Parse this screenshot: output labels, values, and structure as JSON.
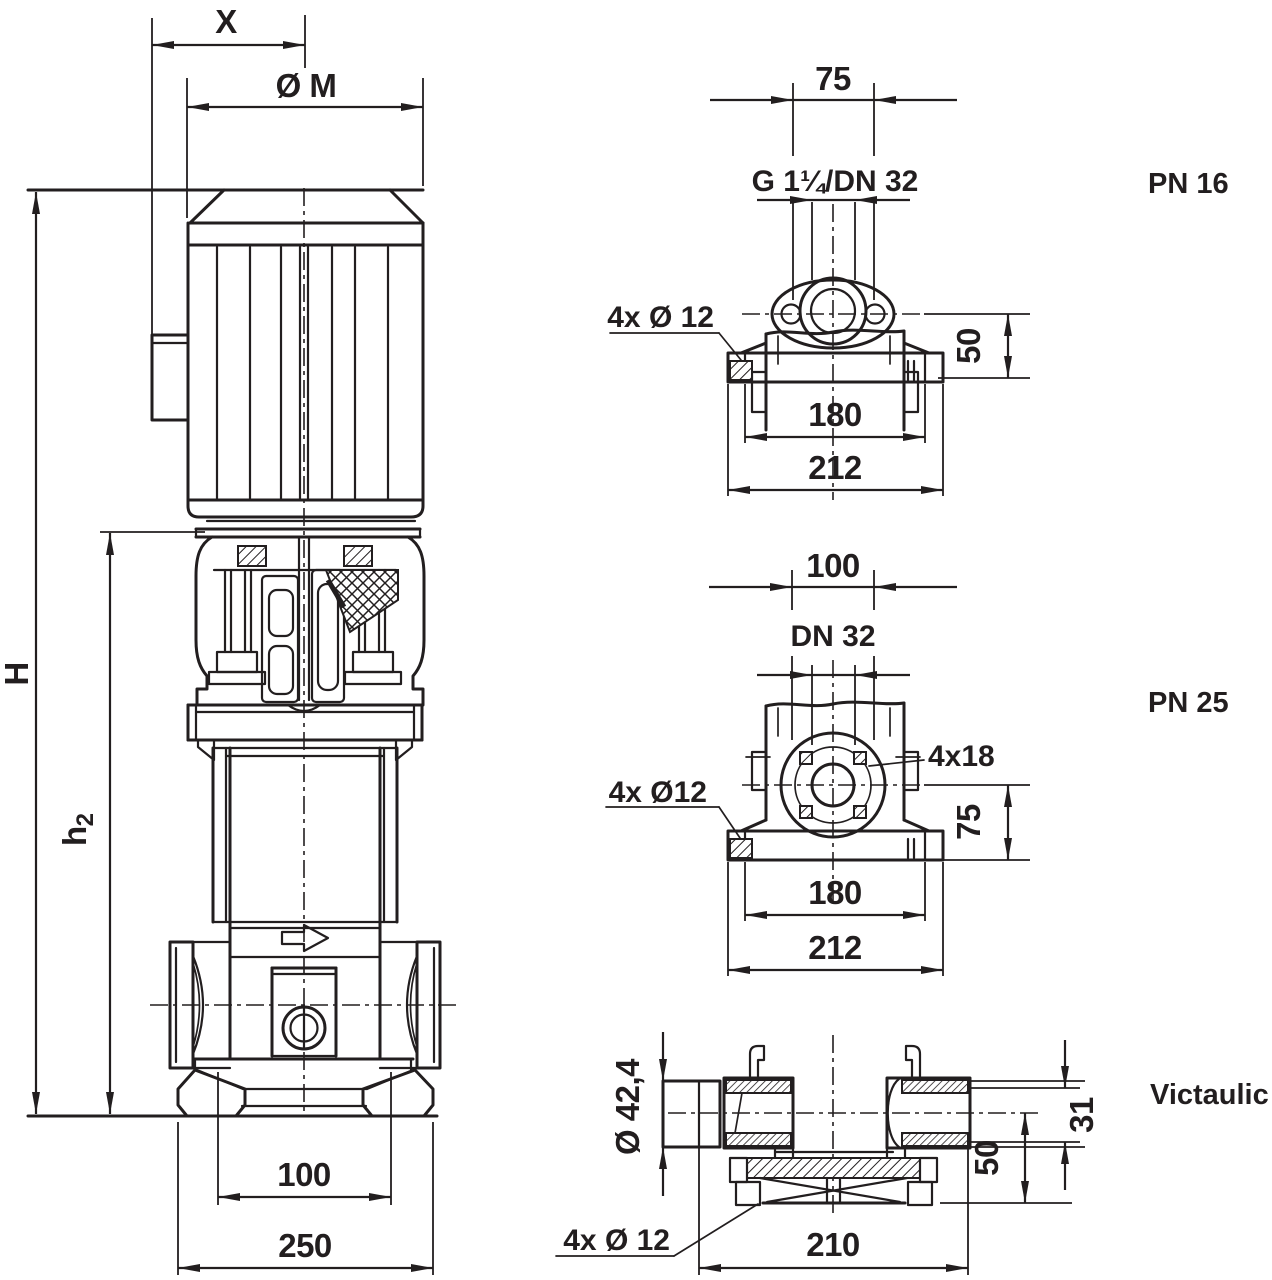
{
  "drawing": {
    "type": "pump-dimension-drawing",
    "ink_color": "#221e1f",
    "background_color": "#ffffff"
  },
  "pump_view": {
    "dim_x": "X",
    "dim_diameter_m": "Ø M",
    "dim_height_h": "H",
    "dim_h2_main": "h",
    "dim_h2_sub": "2",
    "dim_port_center": "100",
    "dim_base_width": "250"
  },
  "pn16_view": {
    "title": "PN 16",
    "dim_top": "75",
    "port_label": "G 1¼/DN 32",
    "holes_label": "4x Ø 12",
    "dim_height": "50",
    "dim_bolt_spacing": "180",
    "dim_base_width": "212"
  },
  "pn25_view": {
    "title": "PN 25",
    "dim_top": "100",
    "port_label": "DN 32",
    "flange_holes_label": "4x18",
    "holes_label": "4x Ø12",
    "dim_height": "75",
    "dim_bolt_spacing": "180",
    "dim_base_width": "212"
  },
  "victaulic_view": {
    "title": "Victaulic",
    "pipe_od_label": "Ø 42,4",
    "holes_label": "4x Ø 12",
    "dim_base_width": "210",
    "dim_height": "50",
    "dim_groove": "31"
  }
}
